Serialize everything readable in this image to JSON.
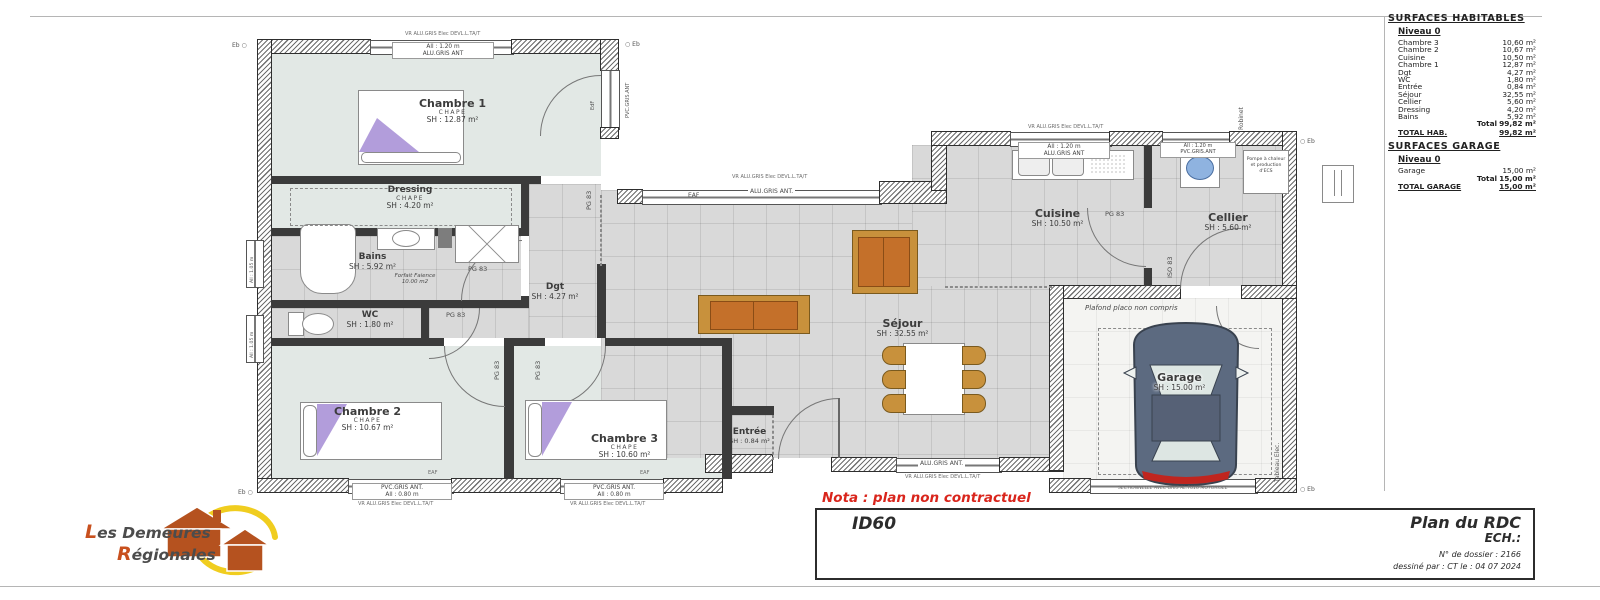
{
  "sheet": {
    "nota": "Nota : plan non contractuel",
    "model": "ID60",
    "title": "Plan du RDC",
    "scale_label": "ECH.:",
    "dossier": "N° de dossier : 2166",
    "drawn_by": "dessiné par : CT   le : 04 07 2024"
  },
  "logo": {
    "line1": "Les Demeures",
    "line2": "Régionales"
  },
  "surfaces": {
    "title": "SURFACES HABITABLES",
    "level": "Niveau 0",
    "rows": [
      {
        "label": "Chambre 3",
        "value": "10,60 m²"
      },
      {
        "label": "Chambre 2",
        "value": "10,67 m²"
      },
      {
        "label": "Cuisine",
        "value": "10,50 m²"
      },
      {
        "label": "Chambre 1",
        "value": "12,87 m²"
      },
      {
        "label": "Dgt",
        "value": "4,27 m²"
      },
      {
        "label": "WC",
        "value": "1,80 m²"
      },
      {
        "label": "Entrée",
        "value": "0,84 m²"
      },
      {
        "label": "Séjour",
        "value": "32,55 m²"
      },
      {
        "label": "Cellier",
        "value": "5,60 m²"
      },
      {
        "label": "Dressing",
        "value": "4,20 m²"
      },
      {
        "label": "Bains",
        "value": "5,92 m²"
      }
    ],
    "total_label": "Total",
    "total_value": "99,82 m²",
    "total_hab_label": "TOTAL HAB.",
    "total_hab_value": "99,82 m²",
    "garage_title": "SURFACES GARAGE",
    "garage_level": "Niveau 0",
    "garage_rows": [
      {
        "label": "Garage",
        "value": "15,00 m²"
      }
    ],
    "garage_total_label": "Total",
    "garage_total_value": "15,00 m²",
    "total_garage_label": "TOTAL GARAGE",
    "total_garage_value": "15,00 m²"
  },
  "rooms": {
    "chambre1": {
      "name": "Chambre 1",
      "sub": "CHAPE",
      "area": "SH : 12.87 m²"
    },
    "dressing": {
      "name": "Dressing",
      "sub": "CHAPE",
      "area": "SH : 4.20 m²"
    },
    "bains": {
      "name": "Bains",
      "area": "SH : 5.92 m²"
    },
    "wc": {
      "name": "WC",
      "area": "SH : 1.80 m²"
    },
    "dgt": {
      "name": "Dgt",
      "area": "SH : 4.27 m²"
    },
    "chambre2": {
      "name": "Chambre 2",
      "sub": "CHAPE",
      "area": "SH : 10.67 m²"
    },
    "chambre3": {
      "name": "Chambre 3",
      "sub": "CHAPE",
      "area": "SH : 10.60 m²"
    },
    "entree": {
      "name": "Entrée",
      "area": "SH : 0.84 m²"
    },
    "sejour": {
      "name": "Séjour",
      "area": "SH : 32.55 m²"
    },
    "cuisine": {
      "name": "Cuisine",
      "area": "SH : 10.50 m²"
    },
    "cellier": {
      "name": "Cellier",
      "area": "SH : 5.60 m²"
    },
    "garage": {
      "name": "Garage",
      "area": "SH : 15.00 m²"
    }
  },
  "ann": {
    "pg83": "PG 83",
    "iso83": "ISO 83",
    "eaf": "EAF",
    "eb": "Eb",
    "robinet": "Robinet",
    "plafond": "Plafond placo non compris",
    "pompe1": "Pompe à chaleur",
    "pompe2": "et production d'ECS",
    "sectionnelle": "SECTIONNELLE AVEC GRIS AL.7016 MOTORISEE",
    "tableau": "Tableau Elec.",
    "forfait1": "Forfait Faience",
    "forfait2": "10.00 m2"
  },
  "win": {
    "vr": "VR ALU.GRIS Elec DEVL.L.TA/T",
    "alu120_l1": "All : 1.20 m",
    "alu120_l2": "ALU.GRIS ANT",
    "pvc80_l1": "PVC.GRIS ANT.",
    "pvc80_l2": "All : 0.80 m",
    "alu_long": "ALU.GRIS ANT.",
    "pvc120_l1": "All : 1.20 m",
    "pvc120_l2": "PVC.GRIS.ANT",
    "edf": "EdF",
    "pvc_v": "PVC.GRIS.ANT",
    "small_v": "All : 1.05 m"
  },
  "colors": {
    "nota_red": "#d9251c",
    "logo_orange": "#b5521f",
    "logo_yellow": "#f0cd1f",
    "car_body": "#5c6a80",
    "purple": "#b29ddb",
    "sofa_orange": "#c4702a",
    "wood_tan": "#c8913c"
  }
}
